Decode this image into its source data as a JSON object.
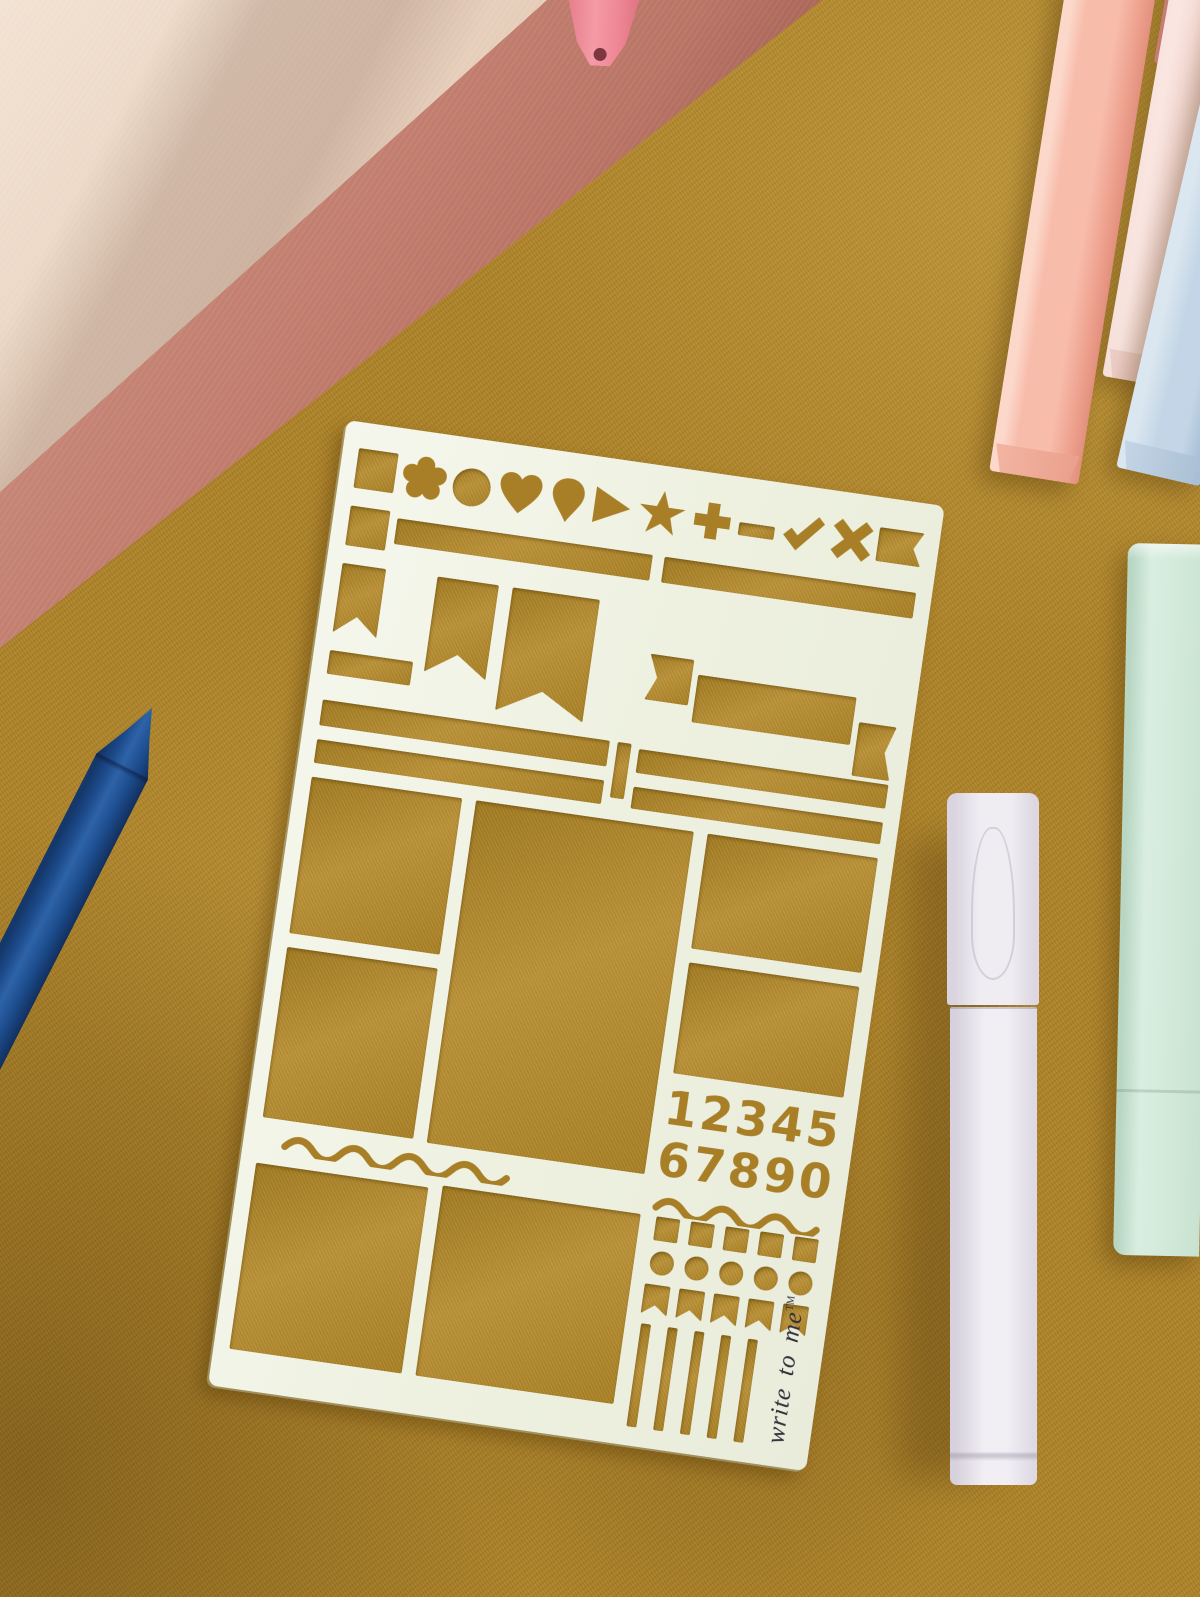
{
  "background": {
    "fabric_color": "#ab8129"
  },
  "stencil": {
    "plastic_color": "#eef1e0",
    "numbers_row_1": "12345",
    "numbers_row_2": "67890",
    "brand": {
      "name": "write to me",
      "trademark": "TM"
    },
    "icon_row": [
      "square",
      "flower",
      "circle",
      "heart",
      "balloon",
      "play-triangle",
      "star",
      "plus",
      "minus",
      "check",
      "cross",
      "flag"
    ],
    "cutout_groups": [
      "icon-row",
      "slot-bars",
      "pennant-banners",
      "ribbon-banner",
      "layout-rectangles",
      "number-digits",
      "wavy-lines",
      "square-dots",
      "round-dots",
      "mini-flags",
      "stripes"
    ]
  },
  "objects": {
    "notebook_top_cover_color": "#e9d3c0",
    "notebook_spine_color": "#b06a5c",
    "pink_pen_tip_color": "#ee8794",
    "salmon_pen_color": "#f8bcab",
    "pale_pink_pen_color": "#f4d6d0",
    "blue_pen_color": "#c3d5e6",
    "mint_case_color": "#d9eee0",
    "lavender_marker_color": "#efecf2",
    "navy_pen_color": "#1c4a8a"
  }
}
